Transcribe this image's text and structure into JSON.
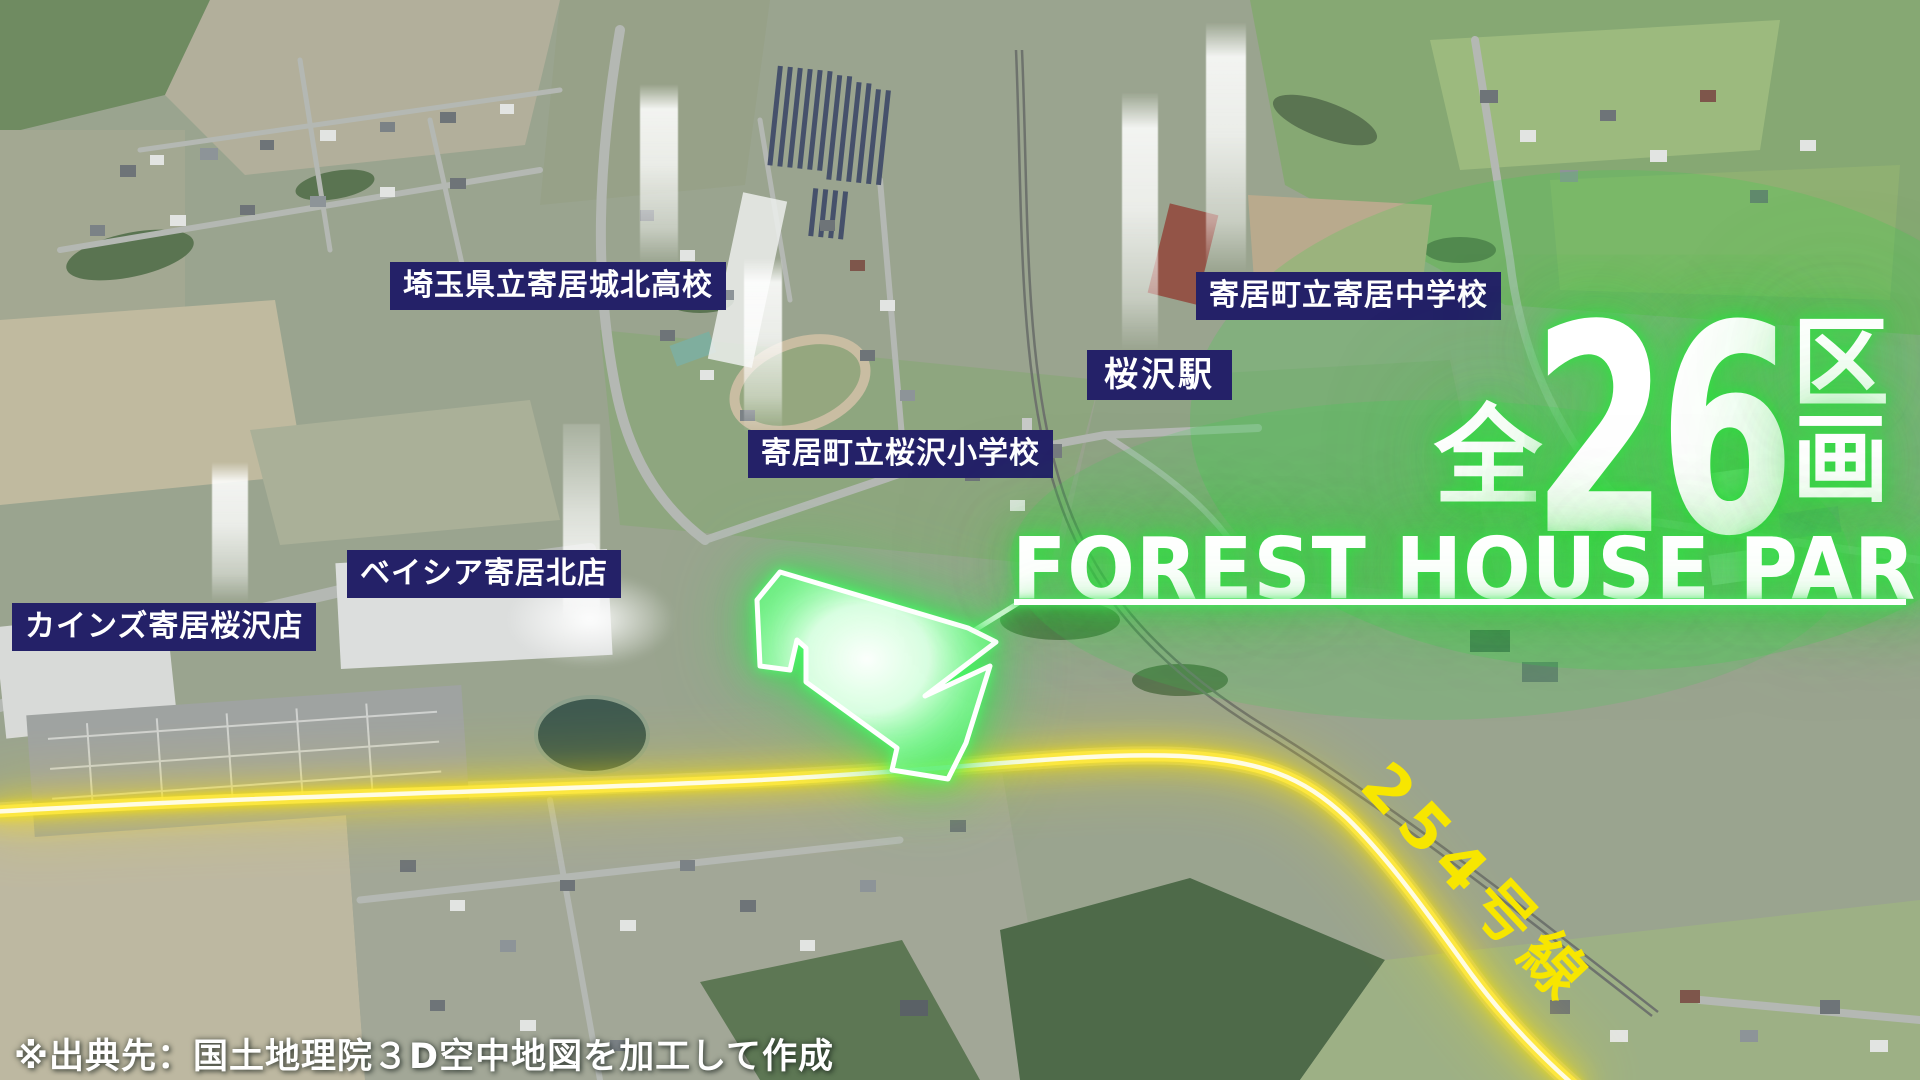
{
  "headline": {
    "prefix": "全",
    "number": "26",
    "unit_top": "区",
    "unit_bottom": "画",
    "name": "FOREST HOUSE PARK"
  },
  "labels": [
    {
      "id": "johoku-high-school",
      "text": "埼玉県立寄居城北高校"
    },
    {
      "id": "yorii-junior-high",
      "text": "寄居町立寄居中学校"
    },
    {
      "id": "sakurazawa-station",
      "text": "桜沢駅"
    },
    {
      "id": "sakurazawa-elementary",
      "text": "寄居町立桜沢小学校"
    },
    {
      "id": "beisia-yorii-kita",
      "text": "ベイシア寄居北店"
    },
    {
      "id": "cainz-yorii-sakurazawa",
      "text": "カインズ寄居桜沢店"
    }
  ],
  "route": {
    "label": "254号線"
  },
  "attribution": {
    "text": "※出典先：国土地理院３D空中地図を加工して作成"
  },
  "colors": {
    "label_background": "#242168",
    "label_text": "#ffffff",
    "glow_green": "#2ed33c",
    "road_yellow": "#ffe600",
    "site_outline": "#ffffff"
  }
}
